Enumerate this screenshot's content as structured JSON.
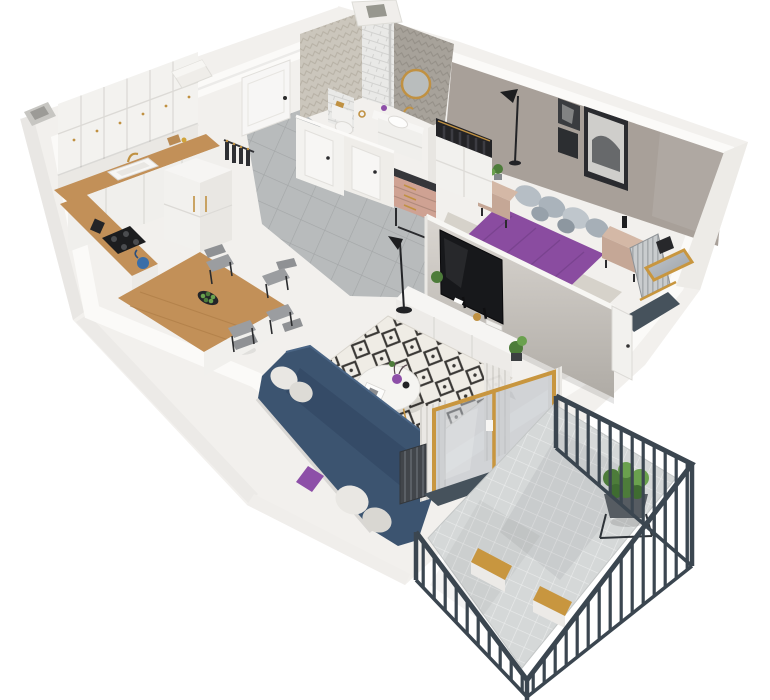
{
  "meta": {
    "title": "3D isometric cutaway floor plan render of a one-bedroom apartment with balcony",
    "view": "axonometric cutaway, walls cut at half height, white background"
  },
  "palette": {
    "bg": "#ffffff",
    "wall_face": "#f2f0ed",
    "wall_cut": "#fbfaf8",
    "wall_shade": "#e9e7e4",
    "accent_wall": "#a8a099",
    "wood_base": "#b5854e",
    "wood_grain": "#9d7040",
    "wood_grain_light": "#c9995f",
    "hall_tile": "#b8bbbc",
    "hall_tile_line": "#a3a6a7",
    "balcony_tile": "#d5d8d8",
    "balcony_tile_line": "#e9ebeb",
    "rug_base": "#efece5",
    "rug_ink": "#3a3835",
    "bedroom_rug": "#d6d2ca",
    "sofa_navy": "#3c5470",
    "sofa_navy_dark": "#2f4360",
    "bed_purple": "#8a4ca0",
    "bed_purple_dark": "#75418b",
    "pillow_purple": "#8d4fa8",
    "pillow_gray": "#aab3bb",
    "tv_black": "#17181b",
    "furniture_white": "#f3f2ef",
    "counter_wood": "#c29058",
    "oak_frame": "#c8963f",
    "brass": "#c09142",
    "railing": "#3b4650",
    "slate": "#46525c",
    "chair_gray": "#9b9da0",
    "plant_green": "#4d7c3a",
    "plant_green_light": "#6aa14e",
    "curtain": "#eae8e4",
    "glass": "#b7bcc2",
    "nightstand_beige": "#c5a796",
    "dresser_pink": "#cfa293",
    "dresser_top": "#35363a",
    "tile_light_herringbone": "#cbc6bc",
    "tile_dark_herringbone": "#a7a29a",
    "tile_subway": "#e9e9e7"
  },
  "rooms": [
    {
      "id": "kitchen-dining",
      "name": "Kitchen / Dining",
      "floor": "herringbone wood"
    },
    {
      "id": "hallway",
      "name": "Entry hall",
      "floor": "gray tile"
    },
    {
      "id": "bathroom",
      "name": "Bathroom",
      "floor": "tile, herringbone tiled walls"
    },
    {
      "id": "bedroom",
      "name": "Bedroom",
      "floor": "herringbone wood with light rug"
    },
    {
      "id": "living-room",
      "name": "Living room",
      "floor": "herringbone wood with diamond rug"
    },
    {
      "id": "balcony",
      "name": "Balcony",
      "floor": "gray tile, dark metal railing"
    }
  ],
  "furniture": {
    "kitchen": [
      "white upper cabinets",
      "marble backsplash",
      "wood countertop",
      "sink with brass faucet",
      "black cooktop",
      "blue kettle",
      "tall white fridge cabinet",
      "coat rack with dark clothes",
      "wood dining table with white island",
      "4 gray chairs",
      "plate of limes"
    ],
    "hallway": [
      "white entrance door",
      "gray floor tiles",
      "two white interior doors"
    ],
    "bathroom": [
      "round gold mirror",
      "white vanity with sink",
      "toilet with brass flush plate",
      "white tiled shower column",
      "brass towel ring"
    ],
    "bedroom": [
      "double bed with purple duvet",
      "gray pillows",
      "two beige nightstands",
      "potted plant",
      "black floor lamp",
      "two black-and-white artworks",
      "white slatted radiator",
      "oak framed window with slate sill",
      "slatted bench",
      "light area rug"
    ],
    "living": [
      "navy sofa with white and purple cushions",
      "black-and-cream diamond rug",
      "round white coffee table",
      "purple vase",
      "black vase",
      "white TV sideboard",
      "flat-screen TV on partition wall",
      "black floor lamp",
      "white curtains",
      "dark radiator",
      "oak framed glass balcony doors"
    ],
    "balcony": [
      "dark metal railing with vertical bars",
      "gray tile floor",
      "two wooden benches",
      "potted plant on black stand",
      "slate threshold"
    ]
  }
}
